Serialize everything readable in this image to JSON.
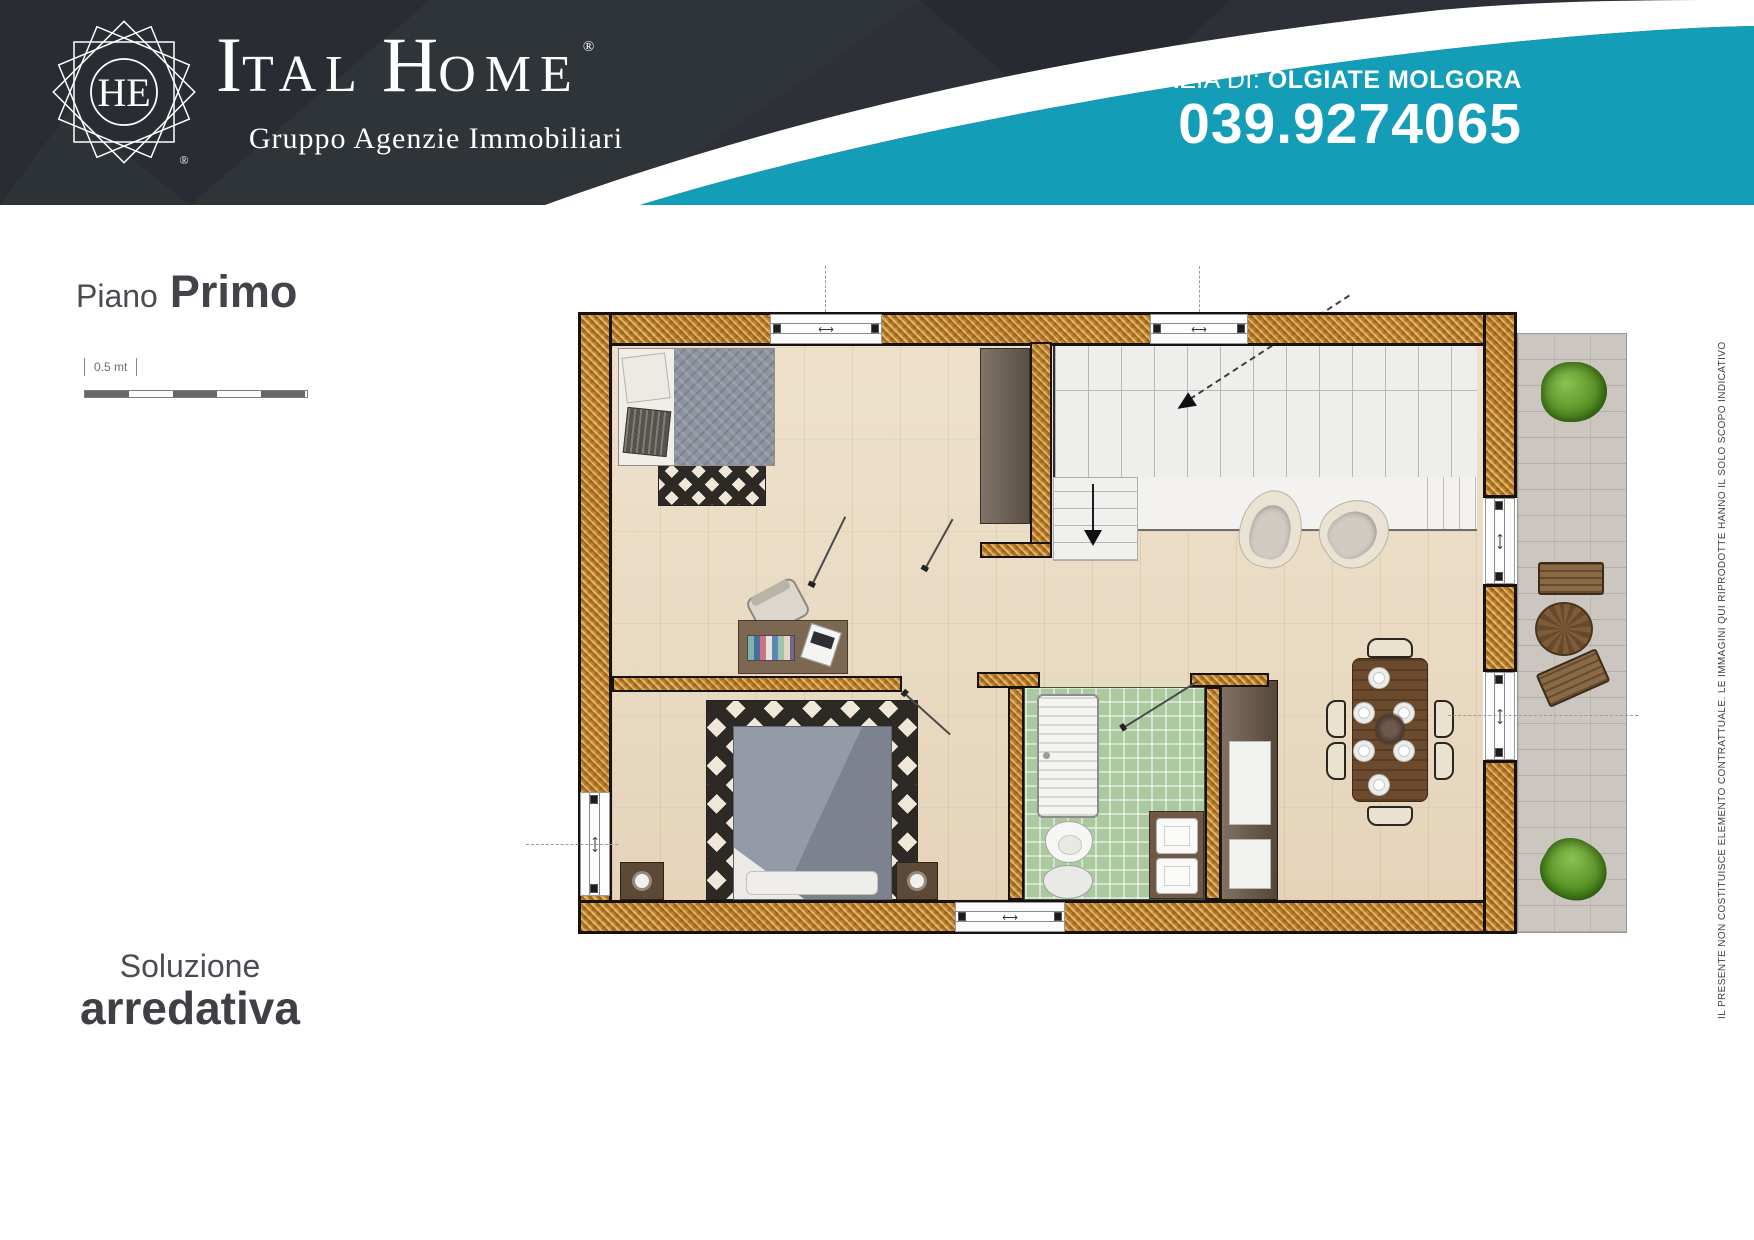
{
  "header": {
    "logo": {
      "monogram": "HE",
      "brand_part1": "I",
      "brand_part2": "TAL",
      "brand_part3": "H",
      "brand_part4": "OME",
      "registered": "®",
      "tagline": "Gruppo Agenzie Immobiliari"
    },
    "agency": {
      "label": "AGENZIA DI: ",
      "name": "OLGIATE MOLGORA",
      "phone": "039.9274065"
    }
  },
  "sidebar": {
    "floor_label": "Piano",
    "floor_name": "Primo",
    "scale_label": "0.5 mt",
    "solution_line1": "Soluzione",
    "solution_line2": "arredativa"
  },
  "footnote": {
    "disclaimer": "IL PRESENTE NON COSTITUISCE ELEMENTO CONTRATTUALE. LE IMMAGINI QUI RIPRODOTTE HANNO IL SOLO SCOPO INDICATIVO"
  },
  "plan": {
    "window_symbol": "⟷"
  },
  "colors": {
    "accent_teal": "#139db6",
    "header_dark": "#2d3137",
    "wall_orange": "#cd8e3b",
    "floor_beige": "#e9dac3",
    "bath_green": "#abc99e",
    "terrace_gray": "#ccc6c0",
    "text_gray": "#4a4a50"
  }
}
